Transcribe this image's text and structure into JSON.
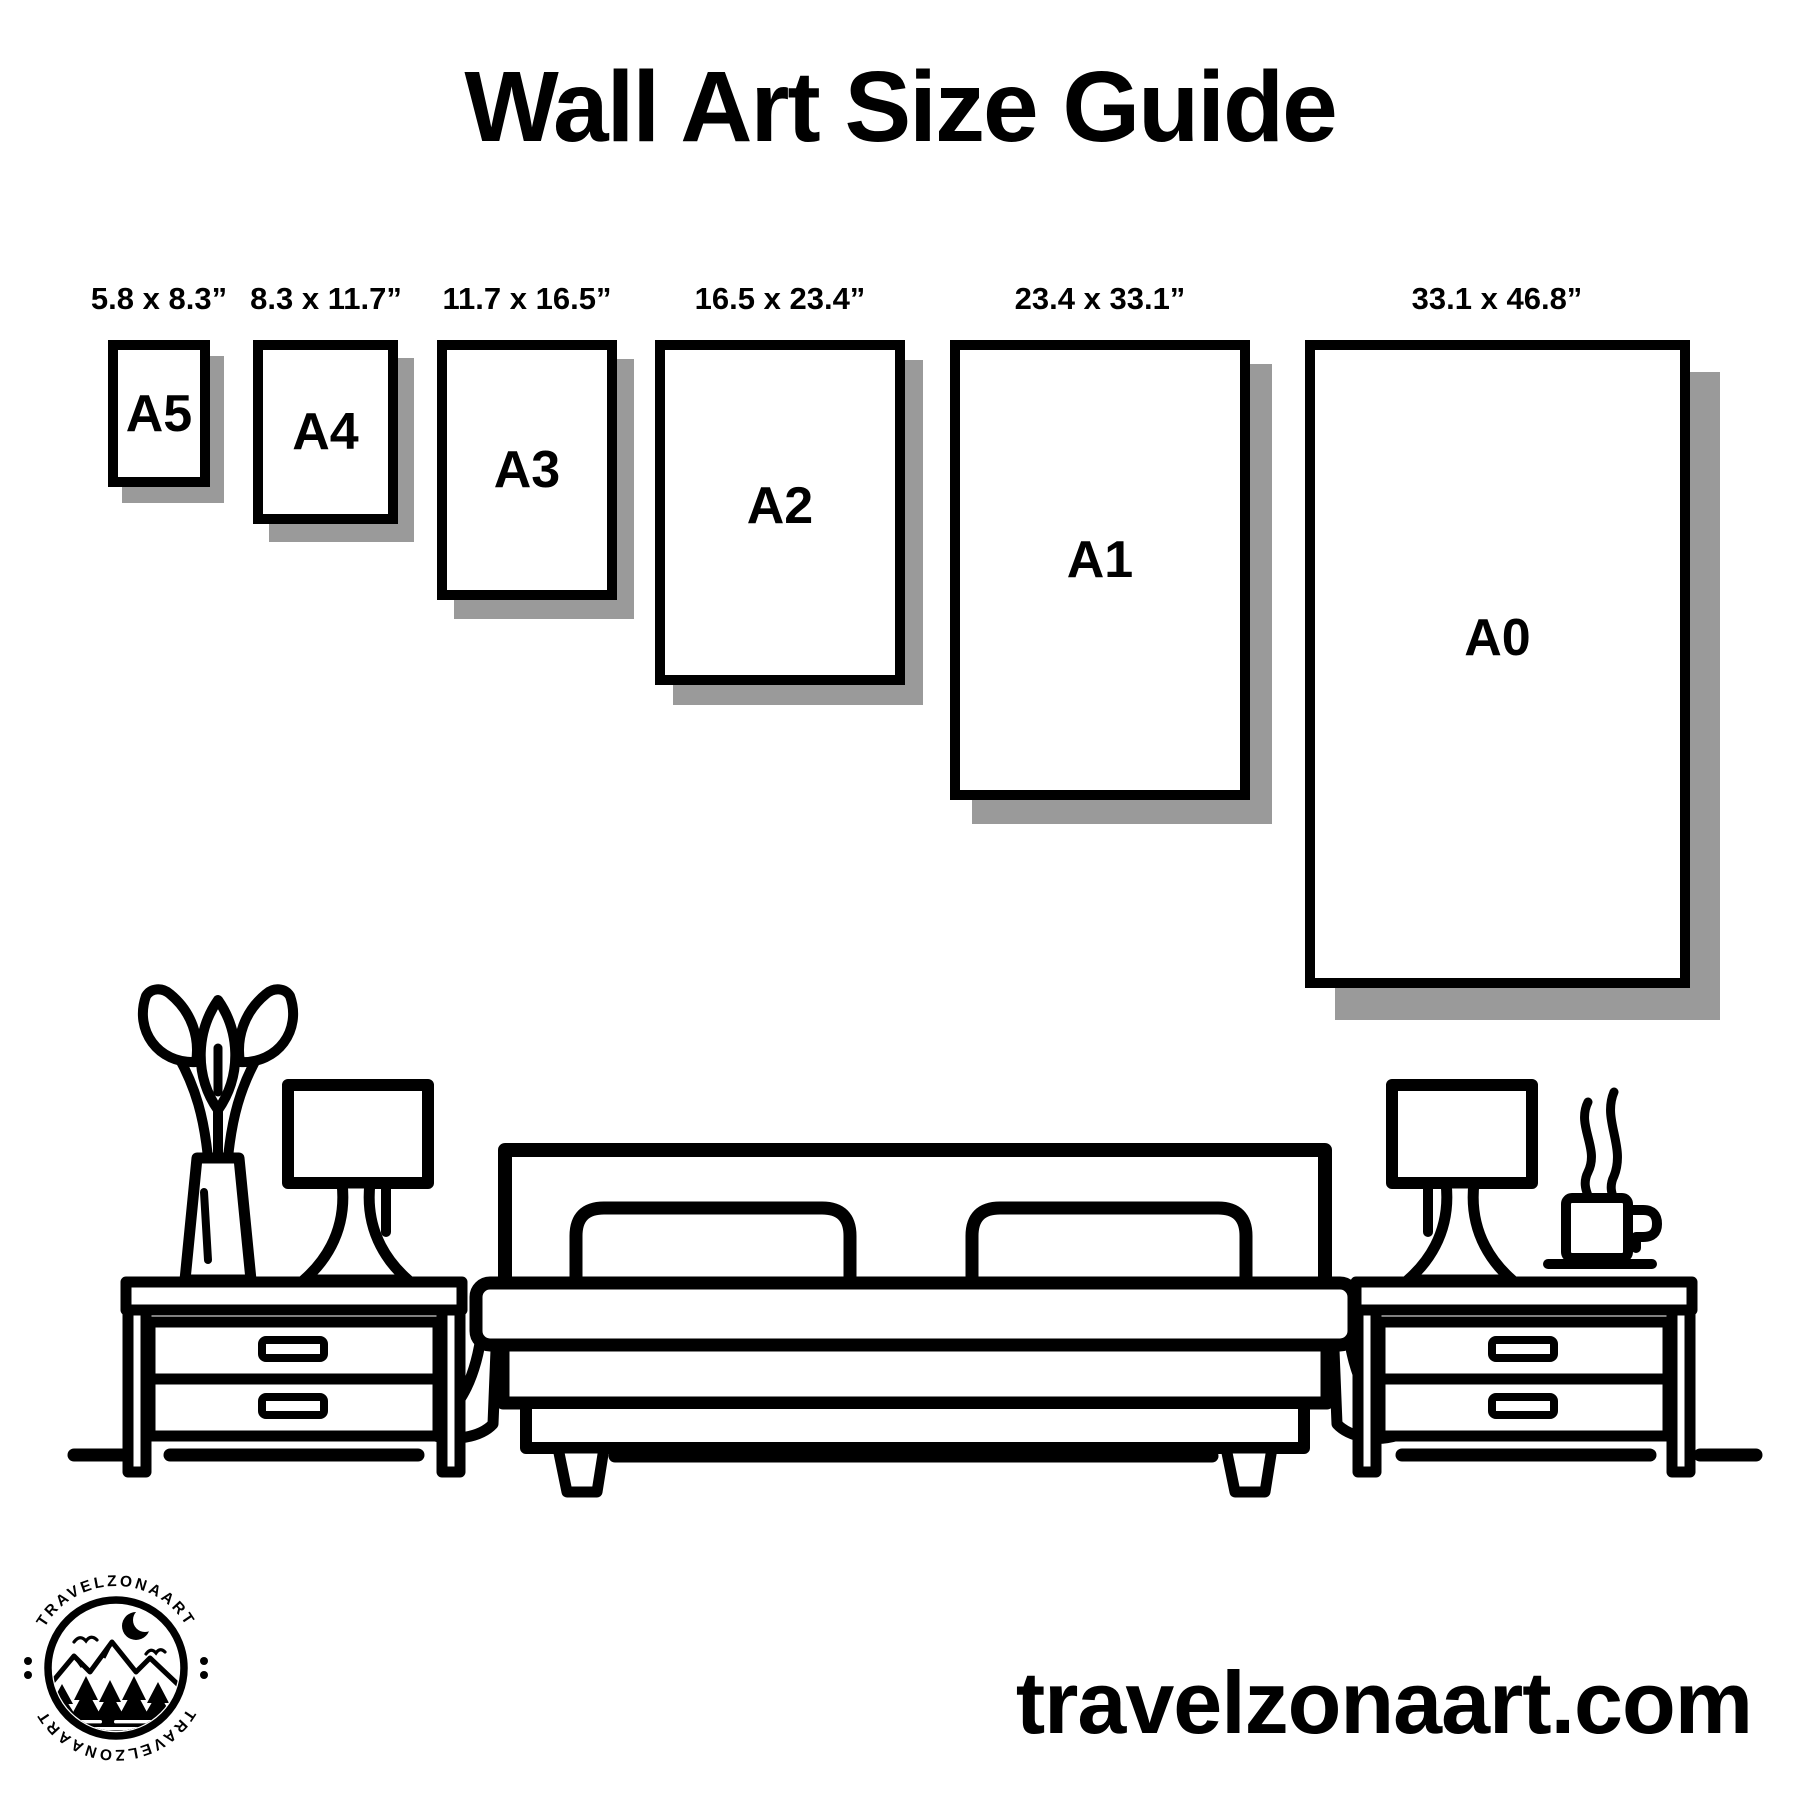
{
  "title": "Wall Art Size Guide",
  "sizes": [
    {
      "name": "A5",
      "label": "5.8 x 8.3”"
    },
    {
      "name": "A4",
      "label": "8.3 x 11.7”"
    },
    {
      "name": "A3",
      "label": "11.7 x 16.5”"
    },
    {
      "name": "A2",
      "label": "16.5 x 23.4”"
    },
    {
      "name": "A1",
      "label": "23.4 x 33.1”"
    },
    {
      "name": "A0",
      "label": "33.1 x 46.8”"
    }
  ],
  "footer": {
    "website": "travelzonaart.com"
  },
  "logo": {
    "text_top": "TRAVELZONAART",
    "text_bottom": "TRAVELZONAART"
  },
  "colors": {
    "ink": "#000000",
    "shadow": "#9a9a9a",
    "background": "#ffffff"
  }
}
